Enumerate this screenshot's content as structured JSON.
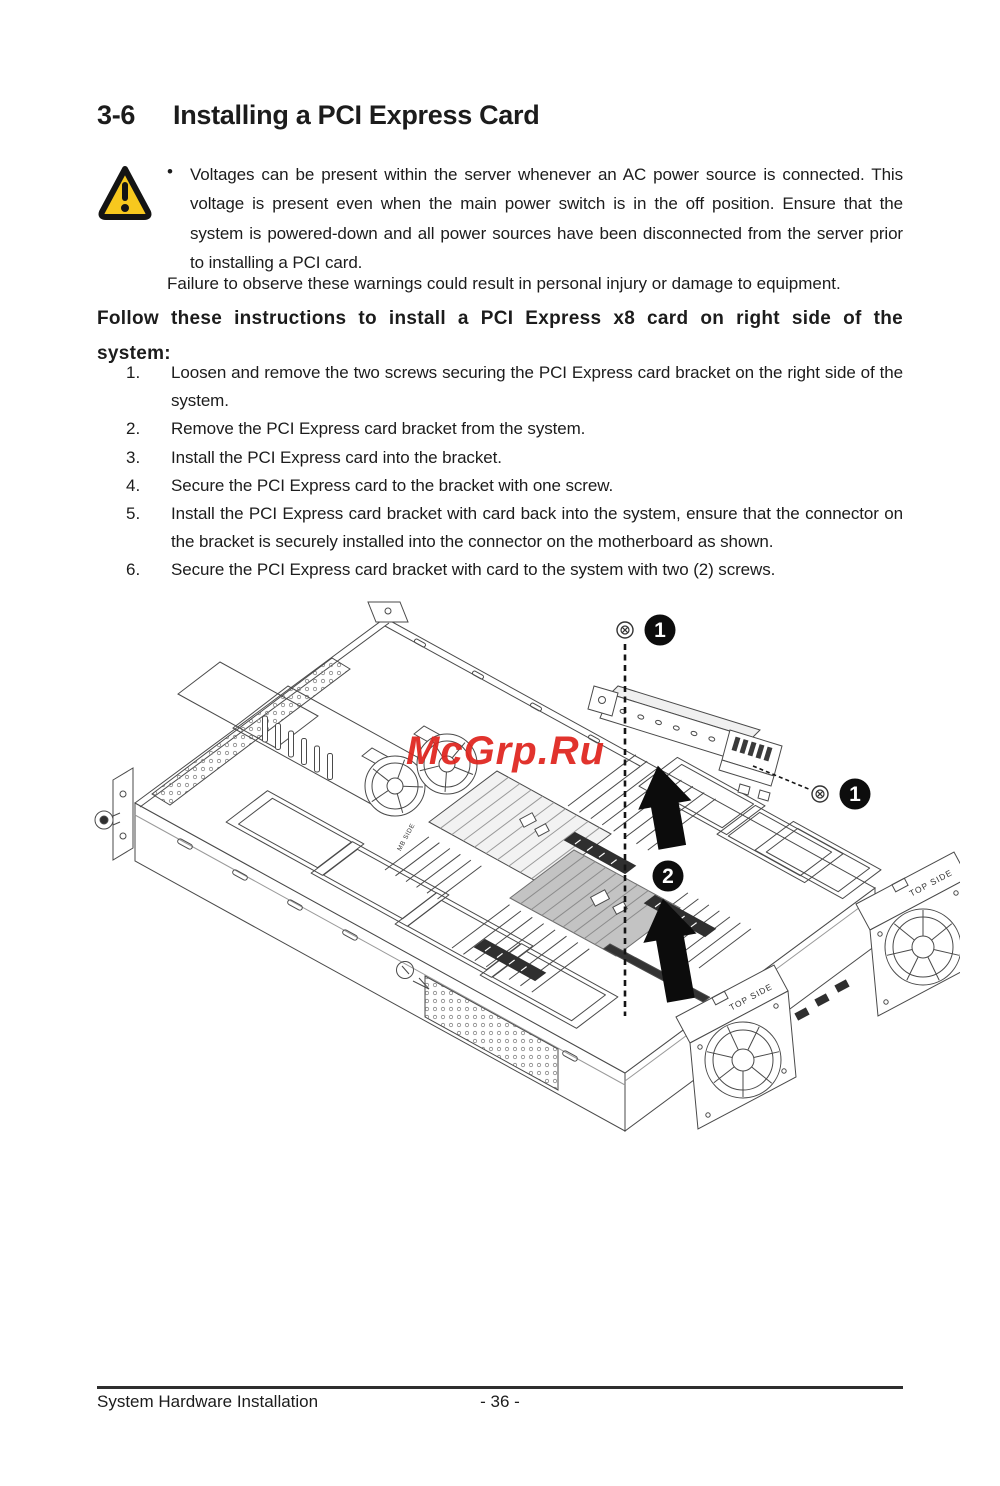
{
  "page": {
    "section": "3-6",
    "title": "Installing a PCI Express Card",
    "footer_left": "System Hardware Installation",
    "footer_page": "- 36 -"
  },
  "warning": {
    "bullet": "•",
    "text": "Voltages can be present within the server whenever an AC power source is connected. This voltage is present even when the main power switch is in the off position. Ensure that the system is powered-down and all power sources have been disconnected from the server prior to installing a PCI card.",
    "note": "Failure to observe these warnings could result in personal injury or damage to equipment."
  },
  "instructions": {
    "heading_line1": "Follow these instructions to install a PCI Express x8 card on right side of the",
    "heading_line2": "system:",
    "steps": [
      {
        "n": "1.",
        "text": "Loosen and remove the two screws securing the PCI Express card bracket on the right side of the system."
      },
      {
        "n": "2.",
        "text": "Remove the PCI Express card bracket from the system."
      },
      {
        "n": "3.",
        "text": "Install the PCI Express card into the bracket."
      },
      {
        "n": "4.",
        "text": "Secure the PCI Express card to the bracket with one screw."
      },
      {
        "n": "5.",
        "text": "Install the PCI Express card bracket with card back into the system, ensure that the connector on the bracket is securely installed into the connector on the motherboard as shown."
      },
      {
        "n": "6.",
        "text": "Secure the PCI Express card bracket with card to the system with two (2) screws."
      }
    ]
  },
  "figure": {
    "watermark": "McGrp.Ru",
    "callout_screw_top": "1",
    "callout_screw_side": "1",
    "callout_connector": "2",
    "label_fan_module_rear": "TOP SIDE",
    "label_fan_module_front": "TOP SIDE",
    "label_mb_side": "MB SIDE"
  },
  "colors": {
    "text": "#1c1c1c",
    "line": "#4a4a4a",
    "watermark_red": "#df231d",
    "warning_yellow": "#f7c81e",
    "callout_black": "#0d0d0d"
  }
}
